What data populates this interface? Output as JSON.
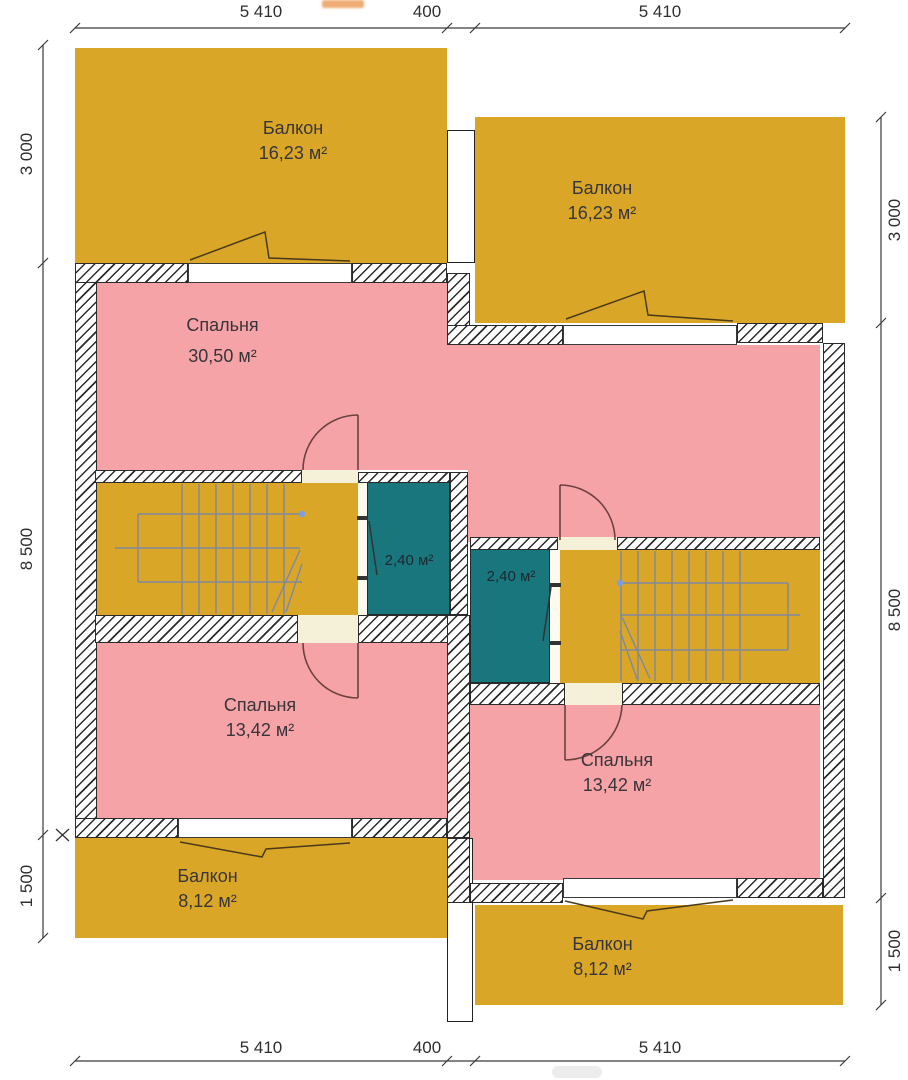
{
  "rooms": {
    "balcony_top_left": {
      "name": "Балкон",
      "area": "16,23 м²"
    },
    "balcony_top_right": {
      "name": "Балкон",
      "area": "16,23 м²"
    },
    "bedroom_main": {
      "name": "Спальня",
      "area": "30,50 м²"
    },
    "storage_left": {
      "area": "2,40 м²"
    },
    "storage_right": {
      "area": "2,40 м²"
    },
    "bedroom_bottom_left": {
      "name": "Спальня",
      "area": "13,42 м²"
    },
    "bedroom_bottom_right": {
      "name": "Спальня",
      "area": "13,42 м²"
    },
    "balcony_bottom_left": {
      "name": "Балкон",
      "area": "8,12 м²"
    },
    "balcony_bottom_right": {
      "name": "Балкон",
      "area": "8,12 м²"
    }
  },
  "dimensions": {
    "top": [
      "5 410",
      "400",
      "5 410"
    ],
    "bottom": [
      "5 410",
      "400",
      "5 410"
    ],
    "left": [
      "3 000",
      "8 500",
      "1 500"
    ],
    "right": [
      "3 000",
      "8 500",
      "1 500"
    ]
  },
  "colors": {
    "balcony_yellow": "#d9a628",
    "room_pink": "#f5a3a6",
    "storage_teal": "#18767c",
    "door_cream": "#f5f1d8"
  }
}
